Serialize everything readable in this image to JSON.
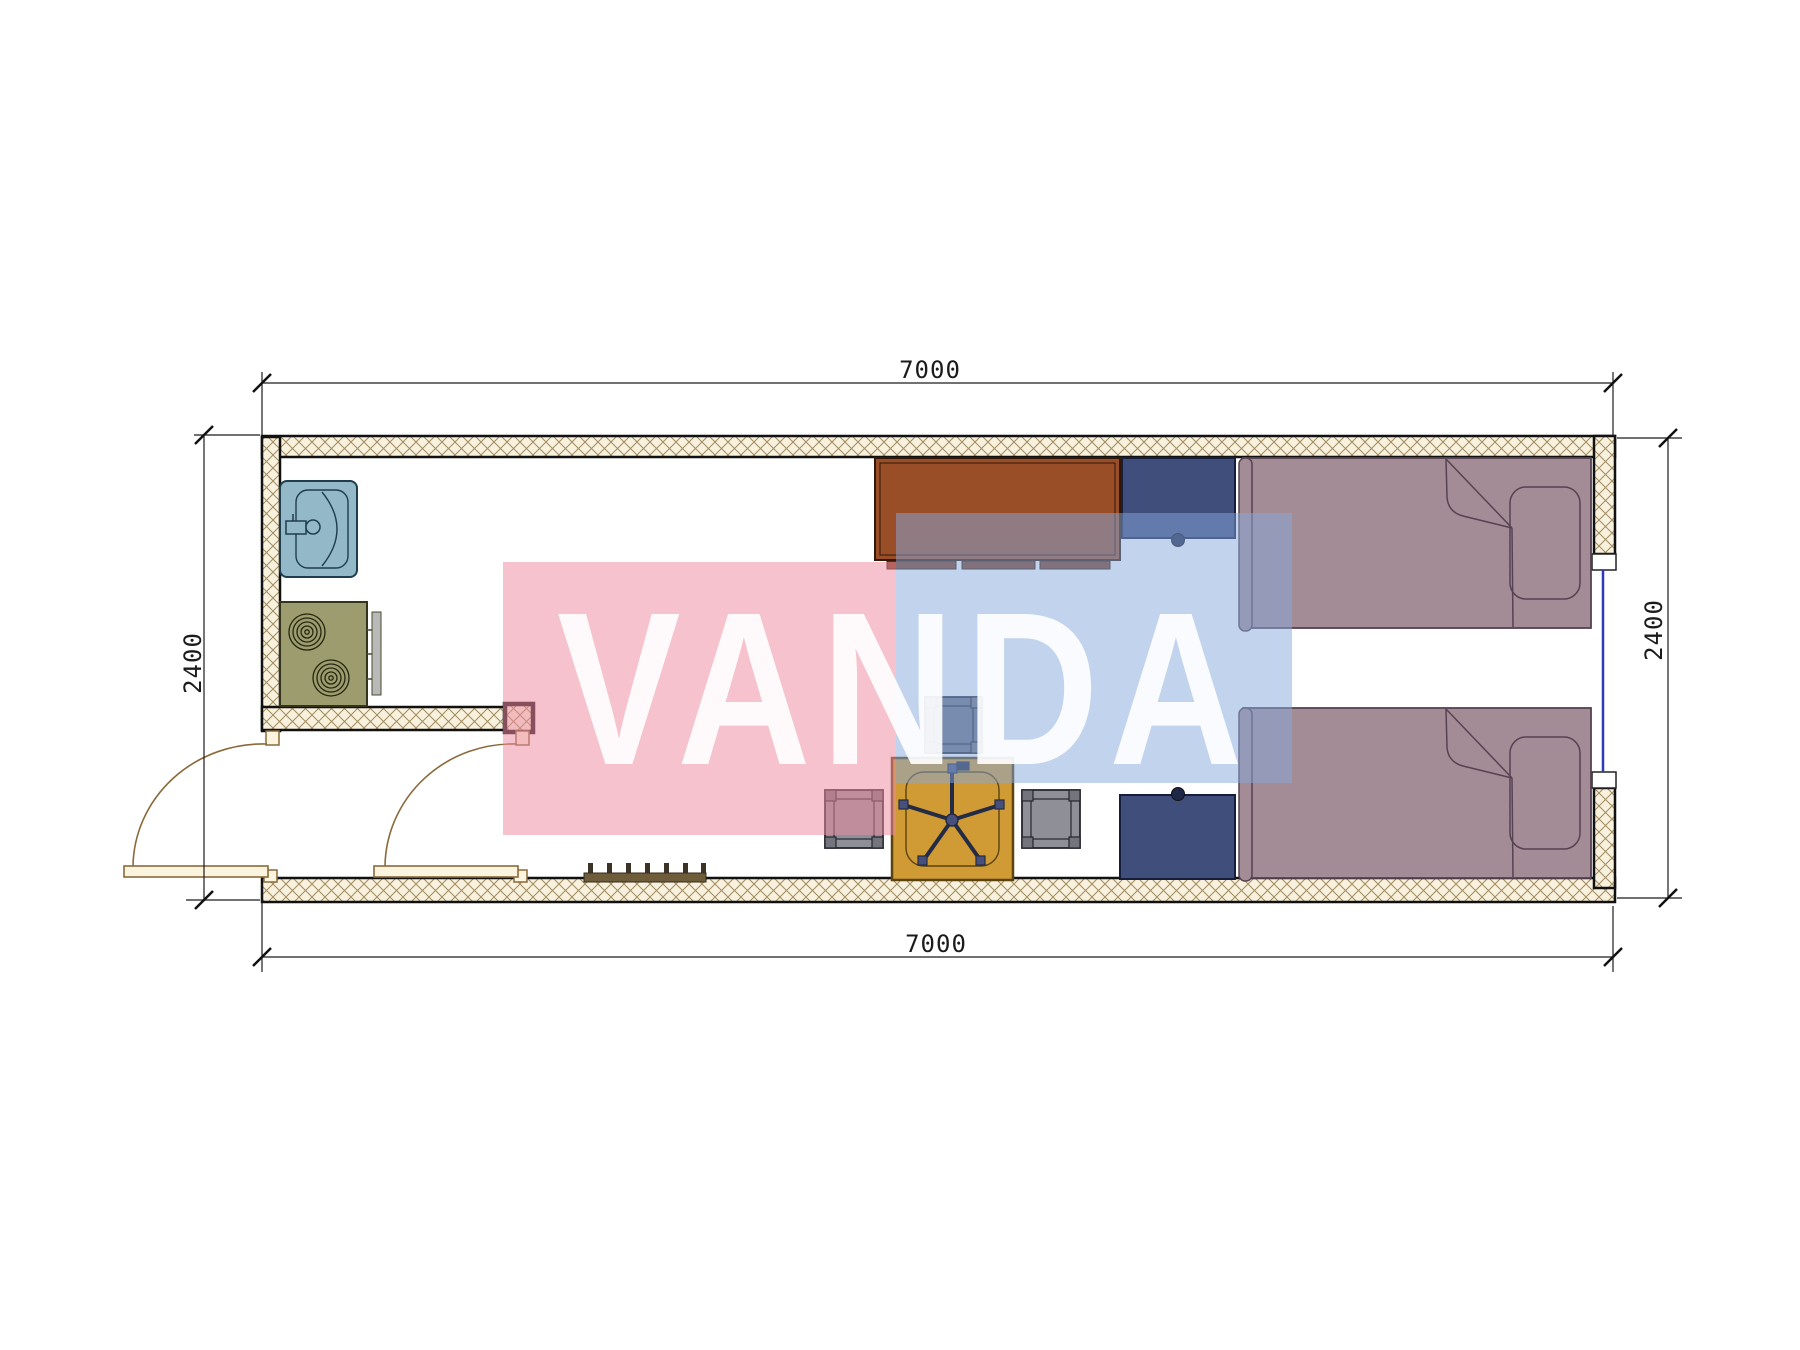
{
  "document": {
    "type": "architectural-floor-plan"
  },
  "dimension_labels": {
    "top": "7000",
    "bottom": "7000",
    "left": "2400",
    "right": "2400"
  },
  "watermark": {
    "text": "VANDA",
    "pink": "#ec8ba0",
    "blue": "#86a8dc"
  },
  "plan": {
    "colors": {
      "hatch_bg": "#f8f1de",
      "hatch_line": "#a28c60",
      "wall_border": "#111111",
      "bed": "#a48c96",
      "bed_line": "#564252",
      "desk": "#9a4e28",
      "desk_dark": "#7e3c1e",
      "nightstand": "#404e7c",
      "nightstand_knob": "#1e2746",
      "table": "#d09b35",
      "stool": "#8f9097",
      "stool_dark": "#6a7183",
      "stool_post": "#73747c",
      "sink": "#93b9c9",
      "stove": "#9c9c6e",
      "stove_panel": "#b9b9b9",
      "door_leaf": "#fbf4de",
      "door_line": "#8a6a3a",
      "mat": "#6e5c3a",
      "window_glass": "#2b3cb4"
    }
  }
}
